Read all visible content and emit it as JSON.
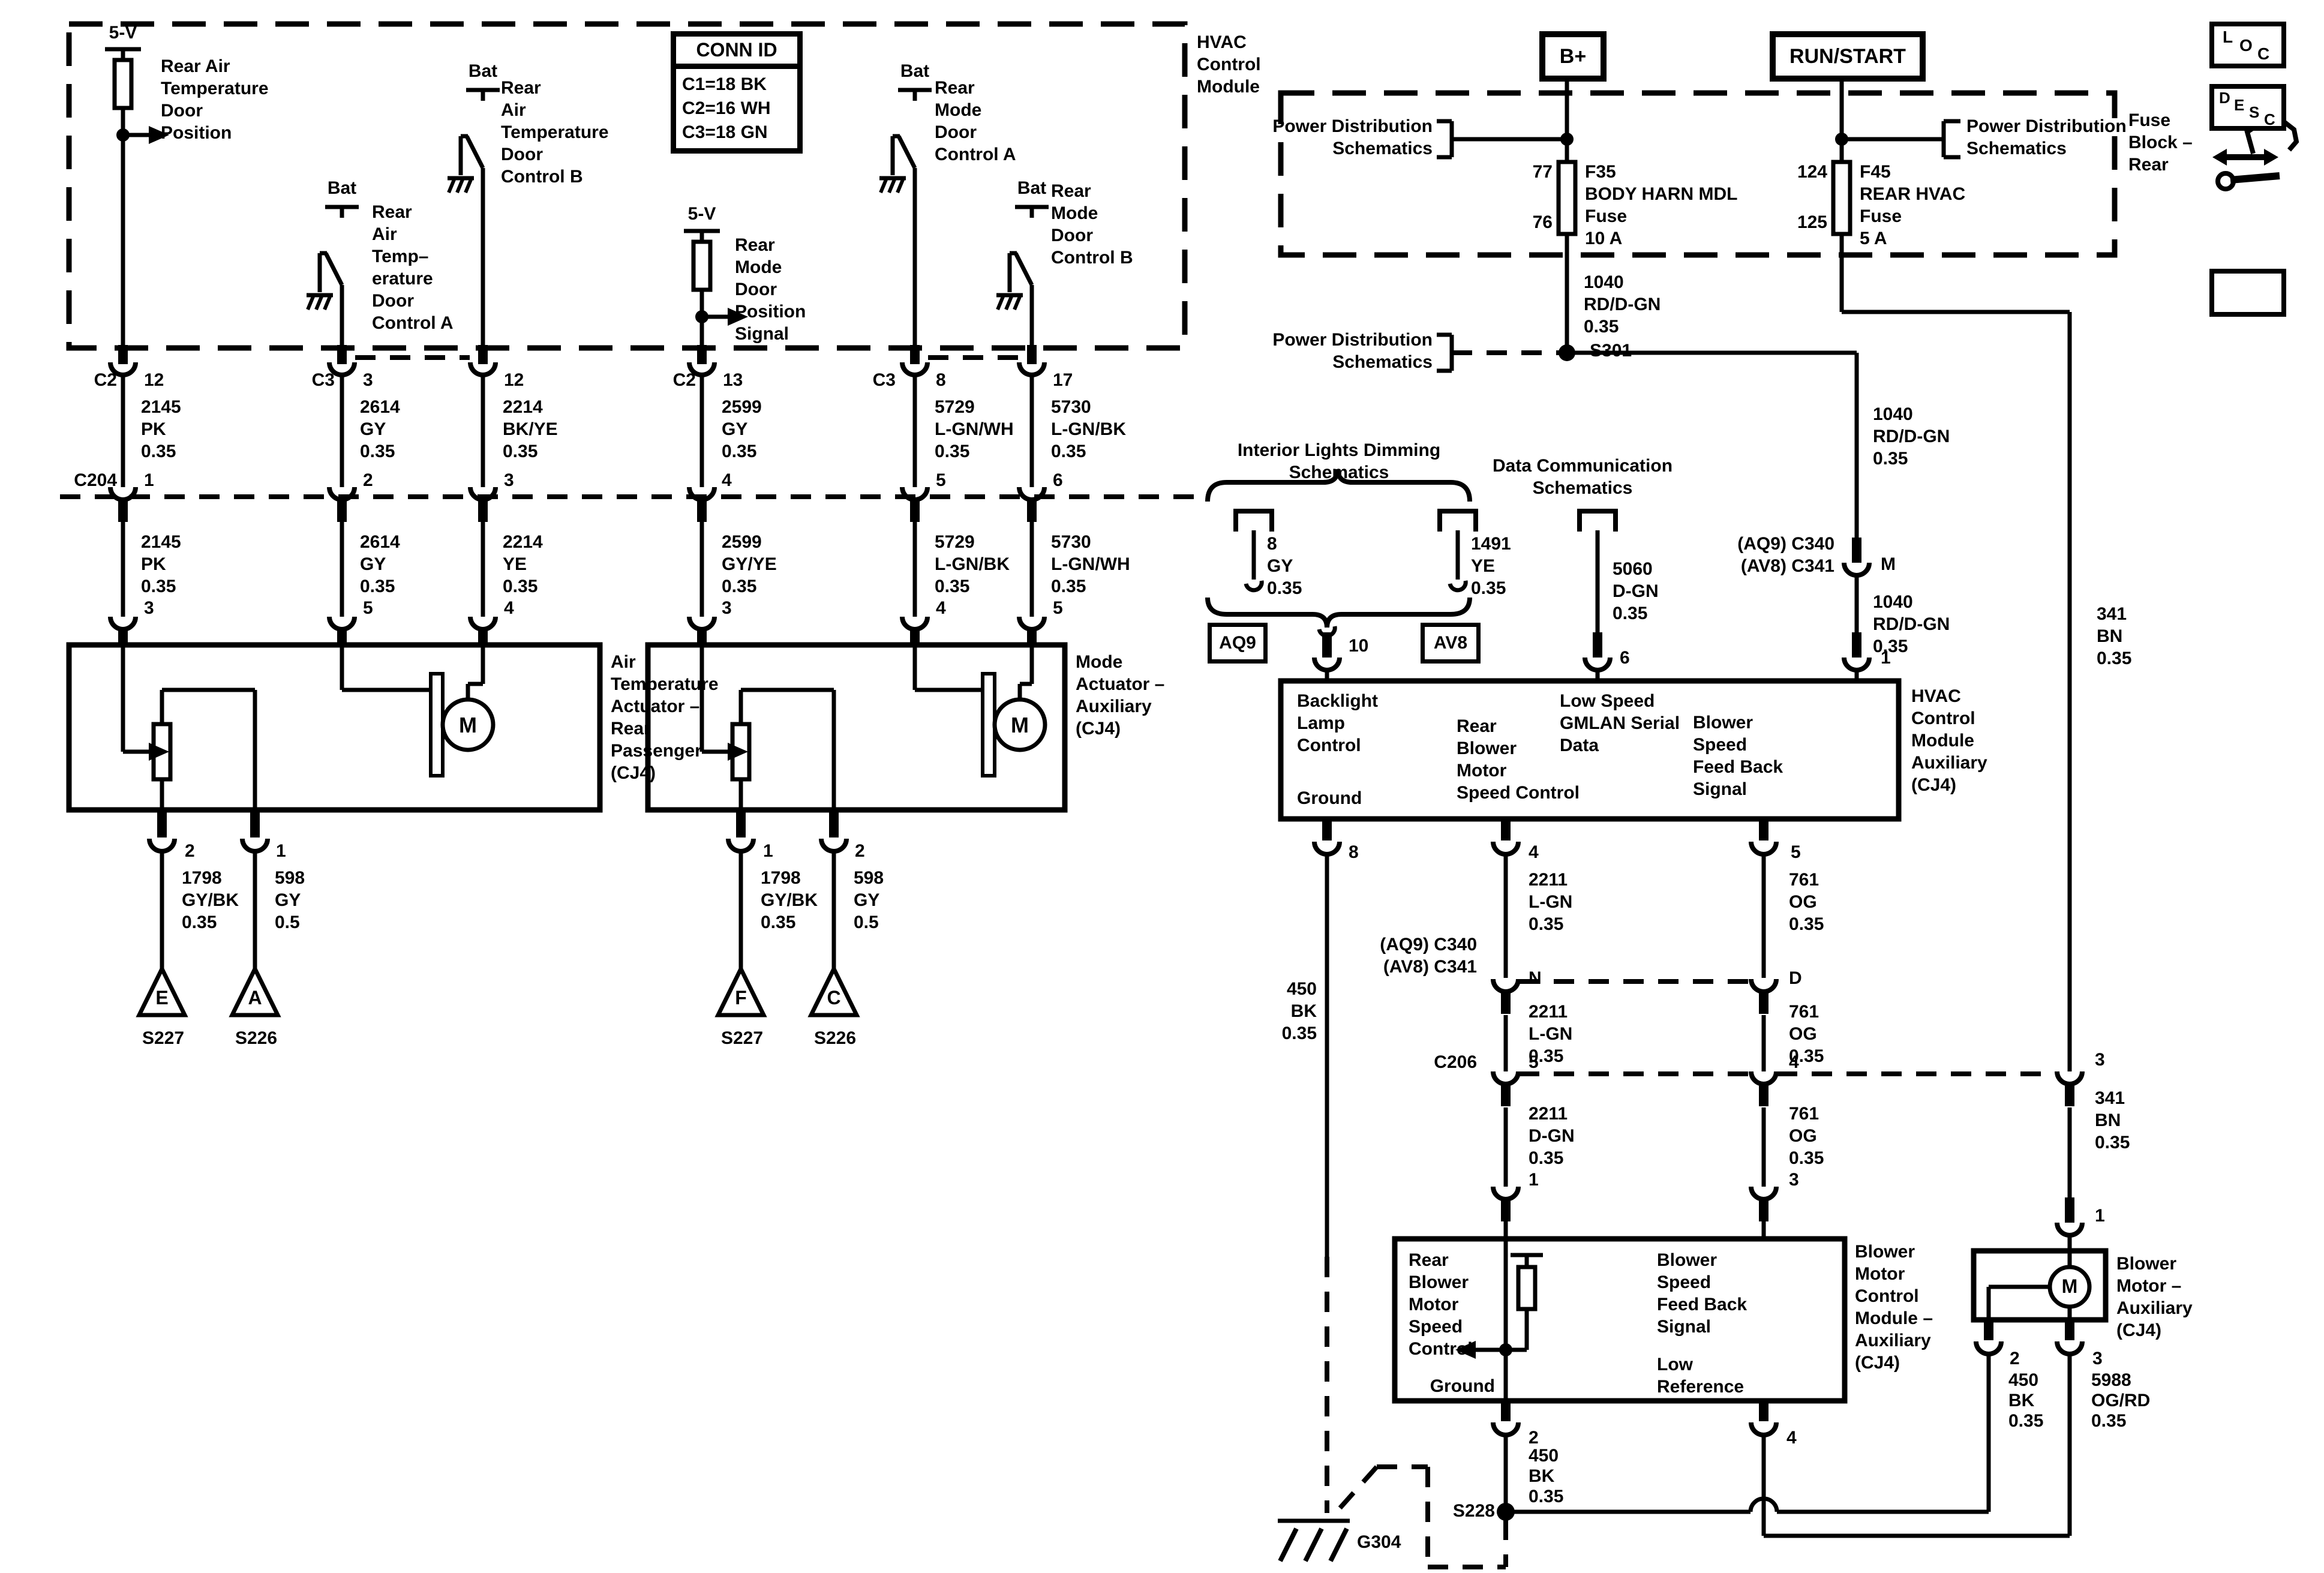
{
  "tm": {
    "title": "HVAC\nControl\nModule",
    "conn_id": {
      "title": "CONN ID",
      "rows": "C1=18 BK\nC2=16 WH\nC3=18 GN"
    },
    "s1": {
      "supply": "5-V",
      "name": "Rear Air\nTemperature\nDoor\nPosition"
    },
    "s2": {
      "supply": "5-V",
      "name": "Rear\nMode\nDoor\nPosition\nSignal"
    },
    "swa": {
      "feed": "Bat",
      "name": "Rear\nAir\nTemp–\nerature\nDoor\nControl A"
    },
    "swb": {
      "feed": "Bat",
      "name": "Rear\nAir\nTemperature\nDoor\nControl B"
    },
    "swc": {
      "feed": "Bat",
      "name": "Rear\nMode\nDoor\nControl A"
    },
    "swd": {
      "feed": "Bat",
      "name": "Rear\nMode\nDoor\nControl B"
    }
  },
  "rows": {
    "c2a": "C2",
    "c3a": "C3",
    "c2b": "C2",
    "c3b": "C3",
    "c204": "C204",
    "tp": [
      "12",
      "3",
      "12",
      "13",
      "8",
      "17"
    ],
    "w1": [
      "2145\nPK\n0.35",
      "2614\nGY\n0.35",
      "2214\nBK/YE\n0.35",
      "2599\nGY\n0.35",
      "5729\nL-GN/WH\n0.35",
      "5730\nL-GN/BK\n0.35"
    ],
    "mp": [
      "1",
      "2",
      "3",
      "4",
      "5",
      "6"
    ],
    "w2": [
      "2145\nPK\n0.35",
      "2614\nGY\n0.35",
      "2214\nYE\n0.35",
      "2599\nGY/YE\n0.35",
      "5729\nL-GN/BK\n0.35",
      "5730\nL-GN/WH\n0.35"
    ],
    "bp": [
      "3",
      "5",
      "4",
      "3",
      "4",
      "5"
    ]
  },
  "act": {
    "left": {
      "name": "Air\nTemperature\nActuator –\nRear\nPassenger\n(CJ4)",
      "motor": "M",
      "pins": [
        "2",
        "1"
      ],
      "wires": [
        "1798\nGY/BK\n0.35",
        "598\nGY\n0.5"
      ],
      "letters": [
        "E",
        "A"
      ],
      "splices": [
        "S227",
        "S226"
      ]
    },
    "right": {
      "name": "Mode\nActuator –\nAuxiliary\n(CJ4)",
      "motor": "M",
      "pins": [
        "1",
        "2"
      ],
      "wires": [
        "1798\nGY/BK\n0.35",
        "598\nGY\n0.5"
      ],
      "letters": [
        "F",
        "C"
      ],
      "splices": [
        "S227",
        "S226"
      ]
    }
  },
  "fb": {
    "label": "Fuse\nBlock –\nRear",
    "bplus": "B+",
    "runstart": "RUN/START",
    "pds": "Power Distribution\nSchematics",
    "f35": {
      "top": "77",
      "bottom": "76",
      "desc": "F35\nBODY HARN MDL\nFuse\n10 A"
    },
    "f45": {
      "top": "124",
      "bottom": "125",
      "desc": "F45\nREAR HVAC\nFuse\n5 A"
    },
    "s301": "S301"
  },
  "feed": {
    "w1040a": "1040\nRD/D-GN\n0.35",
    "w1040b": "1040\nRD/D-GN\n0.35",
    "w1040c": "1040\nRD/D-GN\n0.35",
    "conn": "(AQ9) C340\n(AV8) C341",
    "m": "M",
    "pin1": "1",
    "w341a": "341\nBN\n0.35",
    "w341b": "341\nBN\n0.35",
    "pin3": "3",
    "pin1b": "1"
  },
  "ild": {
    "title": "Interior Lights Dimming\nSchematics",
    "w1": "8\nGY\n0.35",
    "w2": "1491\nYE\n0.35",
    "aq9": "AQ9",
    "av8": "AV8",
    "pin": "10"
  },
  "dcs": {
    "title": "Data Communication\nSchematics",
    "wire": "5060\nD-GN\n0.35",
    "pin": "6"
  },
  "aux": {
    "title": "HVAC\nControl\nModule\nAuxiliary\n(CJ4)",
    "backlight": "Backlight\nLamp\nControl",
    "ground": "Ground",
    "blower": "Rear\nBlower\nMotor\nSpeed Control",
    "gmlan": "Low Speed\nGMLAN Serial\nData",
    "feedback": "Blower\nSpeed\nFeed Back\nSignal",
    "p8": "8",
    "p4": "4",
    "p5": "5"
  },
  "mid": {
    "w450": "450\nBK\n0.35",
    "conn": "(AQ9) C340\n(AV8) C341",
    "n": "N",
    "d": "D",
    "w2211a": "2211\nL-GN\n0.35",
    "w761a": "761\nOG\n0.35",
    "w2211b": "2211\nL-GN\n0.35",
    "w761b": "761\nOG\n0.35",
    "c206": "C206",
    "p5": "5",
    "p4": "4",
    "w2211c": "2211\nD-GN\n0.35",
    "w761c": "761\nOG\n0.35",
    "p1": "1",
    "p3": "3"
  },
  "bmc": {
    "title": "Blower\nMotor\nControl\nModule –\nAuxiliary\n(CJ4)",
    "speed": "Rear\nBlower\nMotor\nSpeed\nControl",
    "ground": "Ground",
    "feedback": "Blower\nSpeed\nFeed Back\nSignal",
    "lowref": "Low\nReference",
    "p2": "2",
    "p4": "4",
    "w450": "450\nBK\n0.35"
  },
  "bm": {
    "title": "Blower\nMotor –\nAuxiliary\n(CJ4)",
    "motor": "M",
    "p1": "1",
    "p2": "2",
    "p3": "3",
    "w450": "450\nBK\n0.35",
    "w5988": "5988\nOG/RD\n0.35"
  },
  "gnd": {
    "s228": "S228",
    "g304": "G304"
  },
  "nav": {
    "loc": [
      "L",
      "O",
      "C"
    ],
    "desc": [
      "D",
      "E",
      "S",
      "C"
    ]
  }
}
